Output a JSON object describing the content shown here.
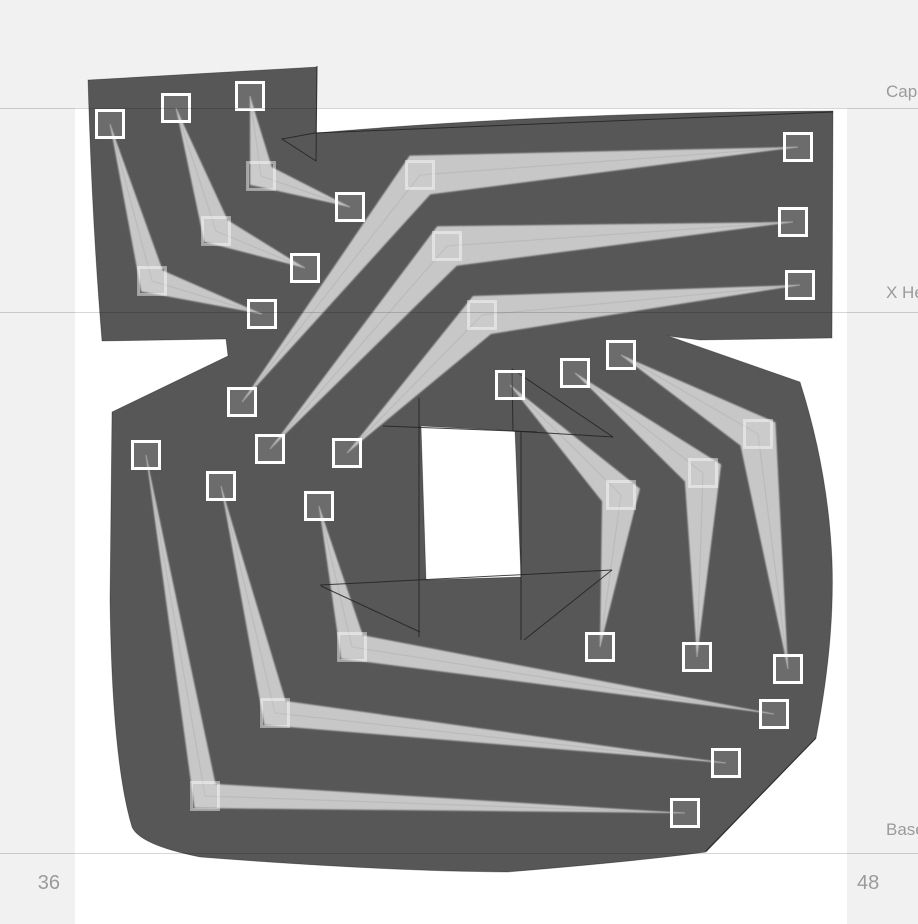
{
  "canvas": {
    "width": 918,
    "height": 924,
    "background": "#ffffff",
    "panel_color": "#f1f1f1",
    "left_panel_width": 75,
    "right_panel_x": 847,
    "top_strip_height": 108
  },
  "metrics": {
    "label_color": "#9b9b9b",
    "guide_color": "rgba(0,0,0,0.16)",
    "guides": [
      {
        "name": "cap-height",
        "y": 108,
        "label": "Cap Height"
      },
      {
        "name": "x-height",
        "y": 312,
        "label": "X Height"
      },
      {
        "name": "baseline",
        "y": 853,
        "label": "Baseline"
      }
    ],
    "numbers": [
      {
        "name": "left-sidebearing-value",
        "text": "36"
      },
      {
        "name": "right-sidebearing-value",
        "text": "48"
      }
    ]
  },
  "glyph": {
    "fill": "#575757",
    "edge_color": "rgba(0,0,0,0.35)",
    "stroke_fill": "#c7c7c7",
    "centerline_color": "#b0b0b0",
    "skeleton_line_color": "#222222",
    "handle_border": "#ffffff",
    "handle_fill": "rgba(255,255,255,0.13)",
    "ghost_border": "rgba(255,255,255,0.45)",
    "ghost_fill": "rgba(255,255,255,0.08)",
    "handle_size": 27,
    "silhouette": "M 88 80 L 317 67 L 316 133 Q 560 112 833 111 L 832 338 L 700 340 L 668 336 L 800 382 Q 828 470 832 560 Q 835 640 816 738 L 706 852 Q 640 861 507 872 Q 380 871 200 857 Q 140 845 132 827 Q 112 760 110 600 L 112 412 L 228 356 L 226 339 L 102 341 Q 92 220 88 80 Z M 421 426 L 515 431 L 521 577 L 426 580 Z",
    "strokes": [
      {
        "a": [
          110,
          124
        ],
        "e": [
          152,
          281
        ],
        "b": [
          262,
          314
        ],
        "w": 15
      },
      {
        "a": [
          176,
          108
        ],
        "e": [
          216,
          231
        ],
        "b": [
          305,
          268
        ],
        "w": 16
      },
      {
        "a": [
          250,
          96
        ],
        "e": [
          261,
          176
        ],
        "b": [
          350,
          207
        ],
        "w": 14
      },
      {
        "a": [
          798,
          147
        ],
        "e": [
          420,
          175
        ],
        "b": [
          242,
          402
        ],
        "w": 22
      },
      {
        "a": [
          793,
          222
        ],
        "e": [
          447,
          246
        ],
        "b": [
          270,
          449
        ],
        "w": 22
      },
      {
        "a": [
          800,
          285
        ],
        "e": [
          482,
          315
        ],
        "b": [
          347,
          453
        ],
        "w": 21
      },
      {
        "a": [
          510,
          385
        ],
        "e": [
          621,
          495
        ],
        "b": [
          600,
          647
        ],
        "w": 20
      },
      {
        "a": [
          575,
          373
        ],
        "e": [
          703,
          473
        ],
        "b": [
          697,
          657
        ],
        "w": 20
      },
      {
        "a": [
          621,
          355
        ],
        "e": [
          758,
          434
        ],
        "b": [
          788,
          669
        ],
        "w": 21
      },
      {
        "a": [
          146,
          455
        ],
        "e": [
          205,
          796
        ],
        "b": [
          685,
          813
        ],
        "w": 16
      },
      {
        "a": [
          221,
          486
        ],
        "e": [
          275,
          713
        ],
        "b": [
          726,
          763
        ],
        "w": 16
      },
      {
        "a": [
          319,
          506
        ],
        "e": [
          352,
          647
        ],
        "b": [
          774,
          714
        ],
        "w": 16
      }
    ],
    "skeleton_lines": [
      [
        [
          317,
          66
        ],
        [
          316,
          161
        ],
        [
          282,
          139
        ],
        [
          315,
          133
        ]
      ],
      [
        [
          315,
          133
        ],
        [
          833,
          112
        ]
      ],
      [
        [
          419,
          398
        ],
        [
          419,
          637
        ]
      ],
      [
        [
          521,
          432
        ],
        [
          521,
          640
        ]
      ],
      [
        [
          383,
          426
        ],
        [
          537,
          432
        ]
      ],
      [
        [
          320,
          585
        ],
        [
          612,
          570
        ]
      ],
      [
        [
          321,
          586
        ],
        [
          420,
          632
        ]
      ],
      [
        [
          612,
          570
        ],
        [
          524,
          640
        ]
      ],
      [
        [
          512,
          369
        ],
        [
          513,
          431
        ]
      ],
      [
        [
          513,
          431
        ],
        [
          613,
          437
        ]
      ],
      [
        [
          512,
          369
        ],
        [
          613,
          437
        ]
      ],
      [
        [
          816,
          738
        ],
        [
          706,
          851
        ]
      ]
    ]
  }
}
